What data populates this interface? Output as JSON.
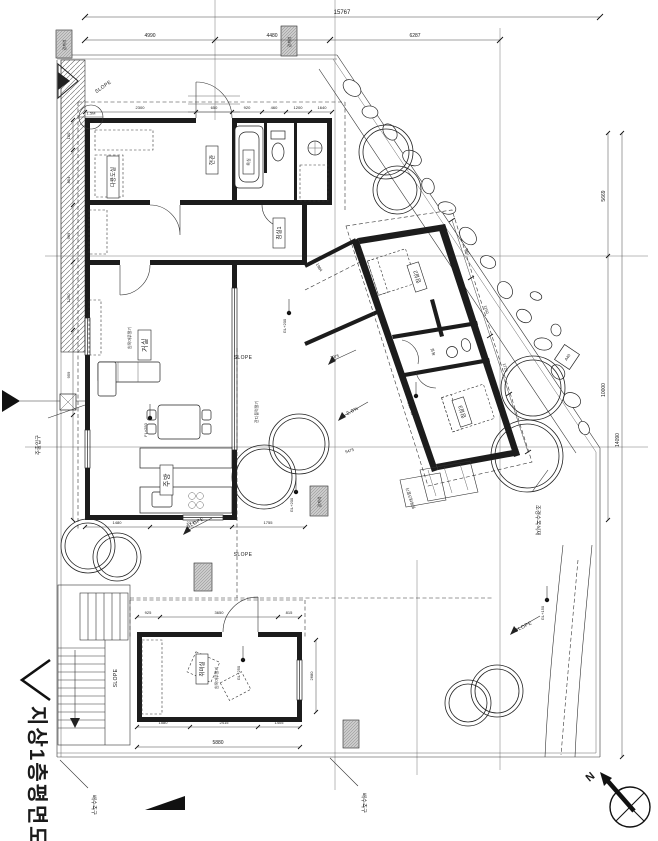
{
  "title": {
    "main": "지상1층평면도",
    "north_label": "N"
  },
  "dimensions": {
    "top_total": "15767",
    "top_segments": [
      "4990",
      "4480",
      "6287"
    ],
    "top_interior": [
      "2300",
      "650",
      "920",
      "460",
      "1200",
      "1640"
    ],
    "left_side": [
      "150",
      "854",
      "969",
      "1260",
      "959"
    ],
    "right_segments": [
      "5669",
      "10000"
    ],
    "right_total": "14090",
    "house_bottom": [
      "1480",
      "2370",
      "1755"
    ],
    "annex_top": [
      "925",
      "3650",
      "815"
    ],
    "annex_bottom": [
      "1580",
      "2415",
      "1405"
    ],
    "annex_total": "5880",
    "annex_right": "2680",
    "wing_side": [
      "940",
      "1150",
      "1725"
    ],
    "wing_total": "5475",
    "corridor": "1984",
    "yard": "3975"
  },
  "rooms": {
    "living": "거실",
    "kitchen": "주방",
    "pantry": "다용도실",
    "entrance": "현관",
    "bath1": "욕실",
    "bedroom1": "침실1",
    "bedroom2": "침실2",
    "bedroom3": "침실3",
    "wing_bath": "욕실",
    "annex": "취미실"
  },
  "annotations": {
    "main_entrance": "주출입구",
    "drain_left": "배수측구",
    "drain_right": "배수측구",
    "planting": "조경수목식재",
    "grass_block": "잔디블럭깔기",
    "wood_deck": "원목데크깔기",
    "wood_floor": "원목마루깔기",
    "boundary_stone": "경계석"
  },
  "levels": {
    "l1": "FL+250",
    "l2": "GL+200",
    "l3": "GL+250",
    "l4": "GL+150",
    "l5": "FL+250",
    "l6": "GL+200"
  },
  "slope": {
    "label": "SLOPE",
    "pct": "2.0%"
  },
  "callouts": {
    "bubble_top": "1.5M",
    "bubble_bottom": "100",
    "diamond": "A40"
  }
}
